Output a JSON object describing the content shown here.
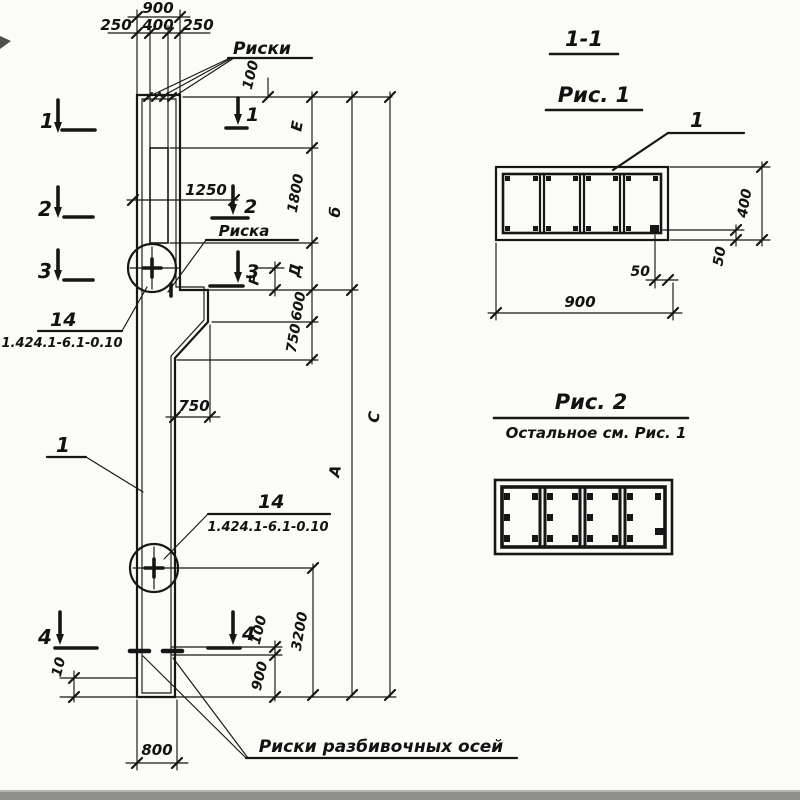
{
  "drawing": {
    "titles": {
      "section_ref": "1-1",
      "fig1": "Рис. 1",
      "fig2": "Рис. 2",
      "fig2_note": "Остальное см. Рис. 1"
    },
    "top_dims": {
      "total": "900",
      "left": "250",
      "middle": "400",
      "right": "250",
      "top_offset": "100"
    },
    "section_marks": {
      "s1": "1",
      "s2": "2",
      "s3": "3",
      "s4": "4"
    },
    "annotations": {
      "riski": "Риски",
      "riska": "Риска",
      "riski_axes": "Риски разбивочных осей",
      "pos_column": "1",
      "pos_embed": "14",
      "embed_code": "1.424.1-6.1-0.10",
      "pos_fig1_bar": "1"
    },
    "right_dims": {
      "E": "Е",
      "h1800": "1800",
      "B": "б",
      "D": "Д",
      "F": "F",
      "h600": "600",
      "h750": "750",
      "A": "А",
      "C": "С"
    },
    "mid_dims": {
      "d1250": "1250",
      "d750": "750",
      "d3200": "3200"
    },
    "bottom_dims": {
      "d100": "100",
      "d900": "900",
      "d10": "10",
      "d800": "800"
    },
    "fig1_dims": {
      "width": "900",
      "height": "400",
      "cover_v": "50",
      "cover_h": "50"
    }
  }
}
